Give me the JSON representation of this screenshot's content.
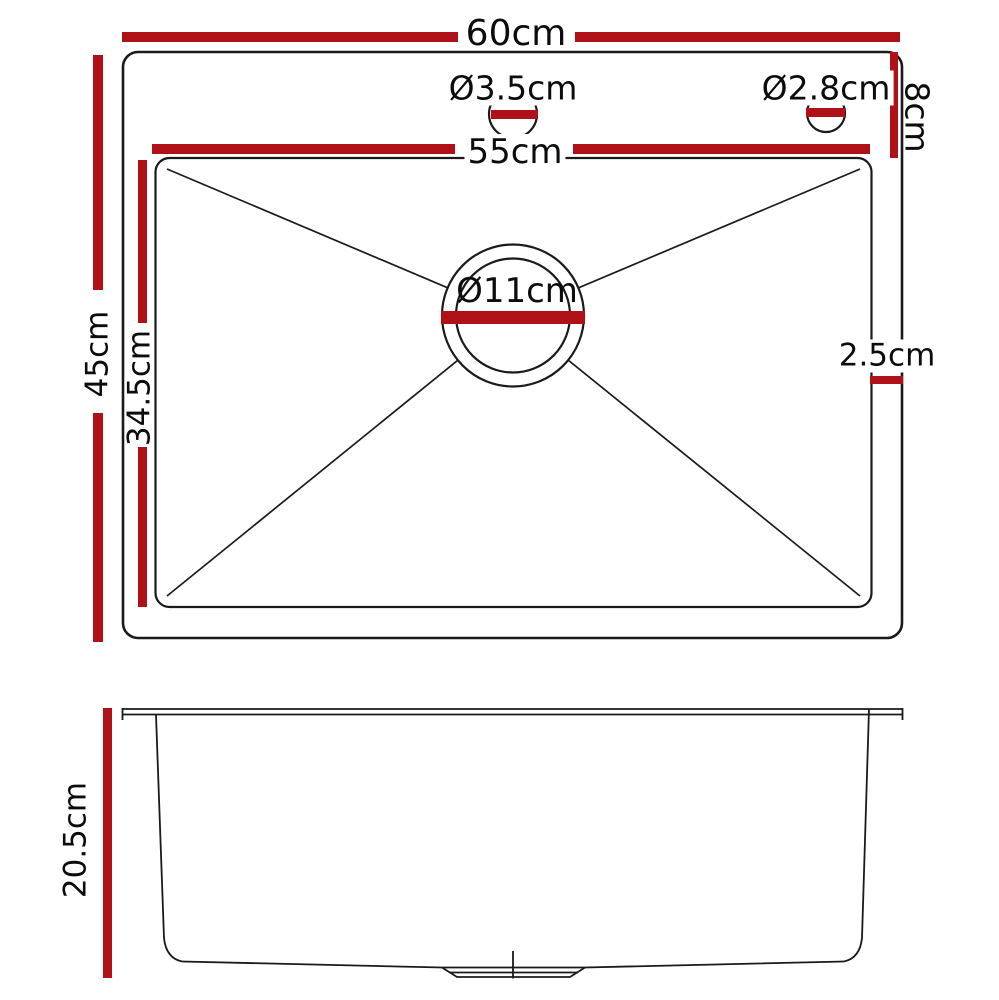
{
  "colors": {
    "dimension_red": "#b01118",
    "line_black": "#1a1a1a",
    "background": "#ffffff"
  },
  "top_view": {
    "overall_width": "60cm",
    "overall_depth": "45cm",
    "bowl_width": "55cm",
    "bowl_depth": "34.5cm",
    "tap_ledge_depth": "8cm",
    "side_gap": "2.5cm",
    "tap_hole_center": "Ø3.5cm",
    "tap_hole_right": "Ø2.8cm",
    "drain_diameter": "Ø11cm"
  },
  "side_view": {
    "depth": "20.5cm"
  }
}
